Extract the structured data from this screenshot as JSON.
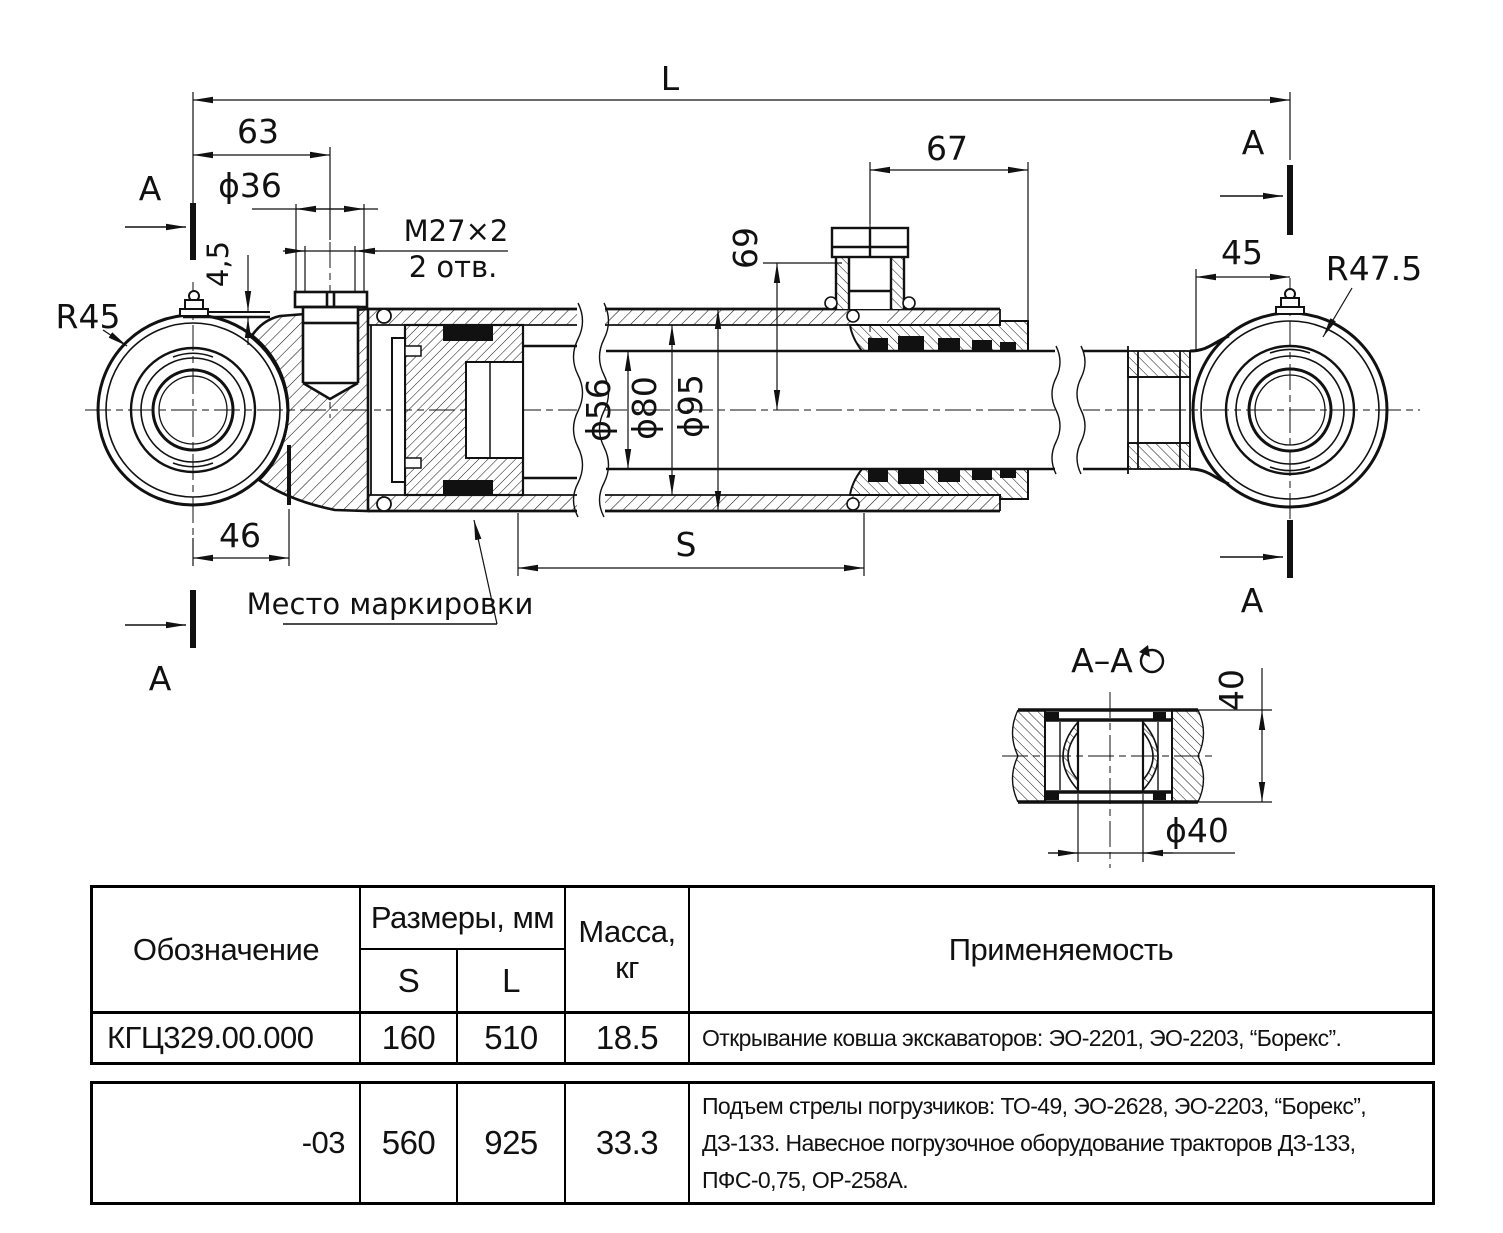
{
  "colors": {
    "ink": "#111111",
    "background": "#ffffff"
  },
  "dims": {
    "L": "L",
    "d63": "63",
    "dia36": "ϕ36",
    "m27": "M27×2",
    "m27_holes": "2 отв.",
    "d45_wall": "4,5",
    "r45": "R45",
    "a": "A",
    "d67": "67",
    "d69": "69",
    "d45": "45",
    "r475": "R47.5",
    "dia56": "ϕ56",
    "dia80": "ϕ80",
    "dia95": "ϕ95",
    "d46": "46",
    "S": "S",
    "marking": "Место маркировки"
  },
  "section": {
    "title": "А–А",
    "d40": "40",
    "dia40": "ϕ40"
  },
  "table": {
    "headers": {
      "designation": "Обозначение",
      "sizes": "Размеры, мм",
      "s": "S",
      "l": "L",
      "mass1": "Масса,",
      "mass2": "кг",
      "application": "Применяемость"
    },
    "rows": [
      {
        "designation": "КГЦ329.00.000",
        "s": "160",
        "l": "510",
        "mass": "18.5",
        "application": [
          "Открывание ковша экскаваторов: ЭО-2201, ЭО-2203, “Борекс”."
        ]
      },
      {
        "designation": "-03",
        "s": "560",
        "l": "925",
        "mass": "33.3",
        "application": [
          "Подъем стрелы погрузчиков: ТО-49, ЭО-2628, ЭО-2203, “Борекс”,",
          "ДЗ-133. Навесное погрузочное оборудование тракторов ДЗ-133,",
          "ПФС-0,75, ОР-258А."
        ]
      }
    ]
  }
}
